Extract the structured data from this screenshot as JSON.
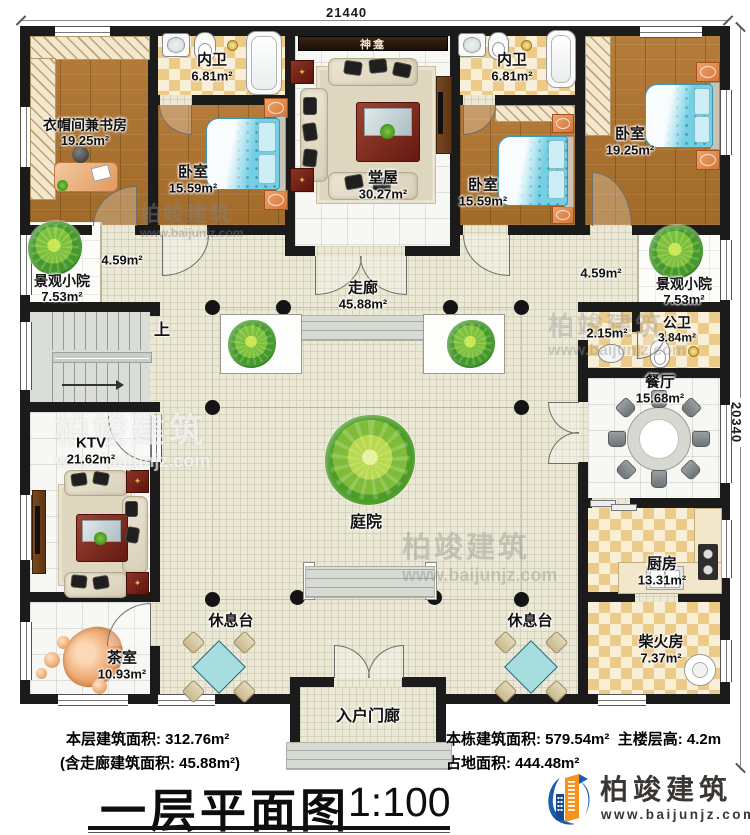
{
  "dimensions": {
    "top_width": "21440",
    "right_height": "20340"
  },
  "rooms": {
    "cloakroom_study": {
      "name": "衣帽间兼书房",
      "area": "19.25m²"
    },
    "inner_bath_left": {
      "name": "内卫",
      "area": "6.81m²"
    },
    "bedroom_left": {
      "name": "卧室",
      "area": "15.59m²"
    },
    "main_hall": {
      "name": "堂屋",
      "area": "30.27m²"
    },
    "shrine": {
      "name": "神龛"
    },
    "inner_bath_right": {
      "name": "内卫",
      "area": "6.81m²"
    },
    "bedroom_mid": {
      "name": "卧室",
      "area": "15.59m²"
    },
    "bedroom_right": {
      "name": "卧室",
      "area": "19.25m²"
    },
    "small_courtyard_left": {
      "name": "景观小院",
      "area": "7.53m²"
    },
    "small_courtyard_right": {
      "name": "景观小院",
      "area": "7.53m²"
    },
    "corridor": {
      "name": "走廊",
      "area": "45.88m²"
    },
    "corridor_seg_left": {
      "area": "4.59m²"
    },
    "corridor_seg_right": {
      "area": "4.59m²"
    },
    "stairs": {
      "name": "上"
    },
    "public_bath": {
      "name": "公卫",
      "area": "3.84m²"
    },
    "wash_area": {
      "area": "2.15m²"
    },
    "dining": {
      "name": "餐厅",
      "area": "15.68m²"
    },
    "ktv": {
      "name": "KTV",
      "area": "21.62m²"
    },
    "tea_room": {
      "name": "茶室",
      "area": "10.93m²"
    },
    "courtyard": {
      "name": "庭院"
    },
    "kitchen": {
      "name": "厨房",
      "area": "13.31m²"
    },
    "firewood": {
      "name": "柴火房",
      "area": "7.37m²"
    },
    "rest_left": {
      "name": "休息台"
    },
    "rest_right": {
      "name": "休息台"
    },
    "porch": {
      "name": "入户门廊"
    }
  },
  "footer": {
    "area_line1": "本层建筑面积: 312.76m²",
    "area_line2": "(含走廊建筑面积: 45.88m²)",
    "building_area": "本栋建筑面积: 579.54m²",
    "floor_height": "主楼层高: 4.2m",
    "land_area": "占地面积: 444.48m²",
    "title": "一层平面图",
    "scale": "1:100"
  },
  "logo": {
    "brand": "柏竣建筑",
    "site": "www.baijunjz.com"
  },
  "watermark": {
    "brand": "柏竣建筑",
    "site": "www.baijunjz.com"
  },
  "colors": {
    "wall": "#1b1b1b",
    "wood_floor": "#ad7434",
    "checker_tile": "#ecca87",
    "corridor_floor": "#ebe9d6",
    "bed": "#74cfe4",
    "tree": "#44992a",
    "logo_orange": "#f6921e",
    "logo_blue": "#1a5dab"
  }
}
